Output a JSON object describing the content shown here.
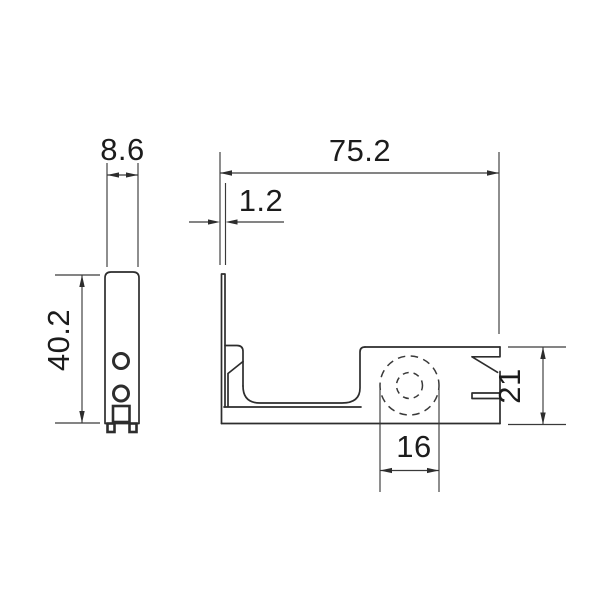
{
  "drawing": {
    "kind": "technical-dimension-drawing",
    "background": "#ffffff",
    "colors": {
      "outline": "#2d2d2d",
      "dimension_lines": "#3a3a3a",
      "text": "#1c1c1c"
    },
    "views": {
      "side_view": "narrow plate with two holes, square socket and two feet",
      "front_view": "thin wall with U-channel and right block with hidden roller circle, wedge notch and clip slot"
    }
  },
  "dimensions": {
    "plate_width": {
      "label": "8.6"
    },
    "overall_width": {
      "label": "75.2"
    },
    "wall_thickness": {
      "label": "1.2"
    },
    "overall_height": {
      "label": "40.2"
    },
    "block_height": {
      "label": "21"
    },
    "roller_width": {
      "label": "16"
    }
  }
}
